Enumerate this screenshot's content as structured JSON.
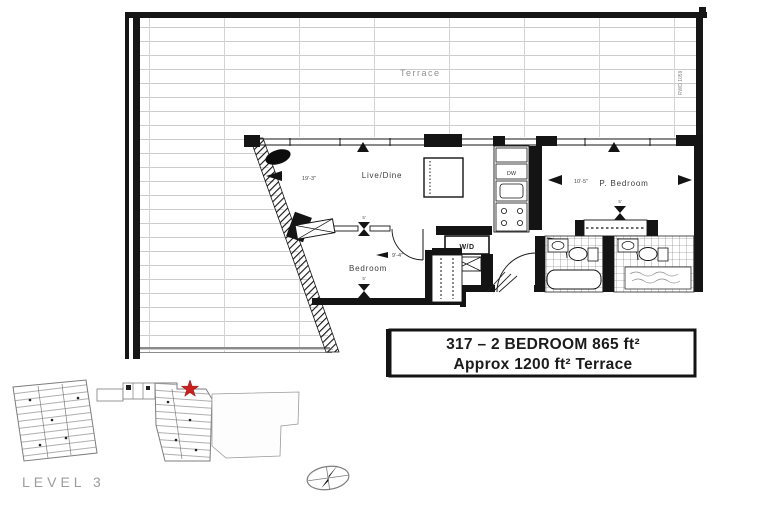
{
  "terrace": {
    "label": "Terrace",
    "side_note": "RWD 1059"
  },
  "rooms": {
    "live_dine": {
      "label": "Live/Dine",
      "dim": "19'-3\""
    },
    "p_bedroom": {
      "label": "P. Bedroom",
      "dim": "10'-5\"",
      "closet_dim": "5'"
    },
    "bedroom": {
      "label": "Bedroom",
      "dim": "9'-4\"",
      "marker_top": "5'",
      "marker_bottom": "5'"
    },
    "laundry": {
      "label": "W/D"
    },
    "kitchen": {
      "dishwasher_label": "DW"
    }
  },
  "info_box": {
    "line1": "317 – 2 BEDROOM 865 ft²",
    "line2": "Approx 1200 ft² Terrace"
  },
  "key_plan": {
    "level_label": "LEVEL 3"
  },
  "colors": {
    "wall": "#141414",
    "deck_line": "#cccccc",
    "railing": "#8a8a8a",
    "keyplan_line": "#7d7d7d",
    "marker_red": "#cc2020",
    "info_text": "#1b1b1b"
  }
}
